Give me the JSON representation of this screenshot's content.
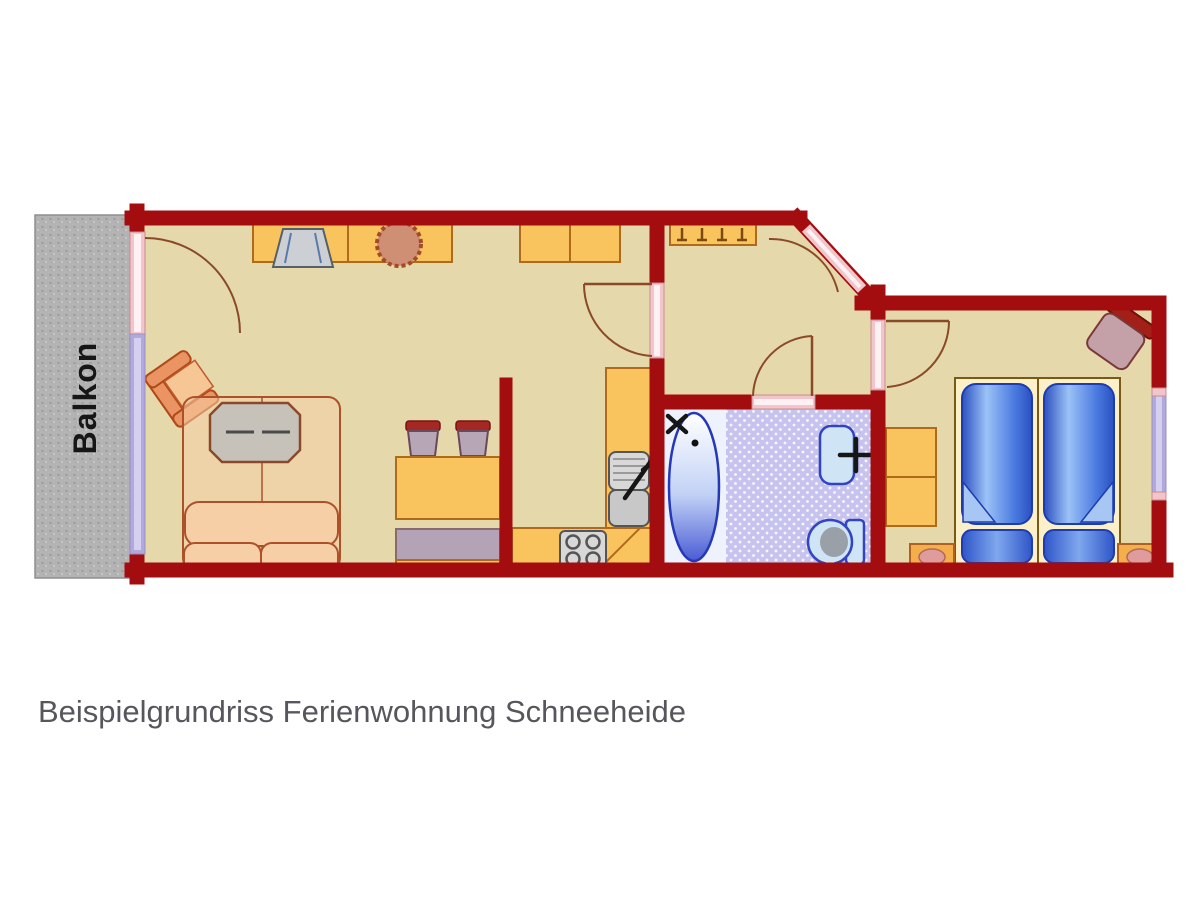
{
  "caption": "Beispielgrundriss Ferienwohnung Schneeheide",
  "balcony_label": "Balkon",
  "colors": {
    "wall": "#a30d10",
    "floor": "#e5d8aa",
    "cabinet": "#f9c45e",
    "cabinet_border": "#b06a1c",
    "balcony": "#b3b3b3",
    "tile": "#c7c3ef",
    "door_pink": "#f1c5ca",
    "window_lavender": "#b1a8dc",
    "fixture_fill": "#cfe5f5",
    "fixture_outline": "#3244c2",
    "sofa_fill": "#f6cfa6",
    "sofa_outline": "#ad512a",
    "bed_frame": "#fcf0c8",
    "shelf_gray": "#b4a3b6",
    "stool_cap": "#a42824",
    "door_arc": "#8a4a28",
    "caption_text": "#56565c"
  }
}
